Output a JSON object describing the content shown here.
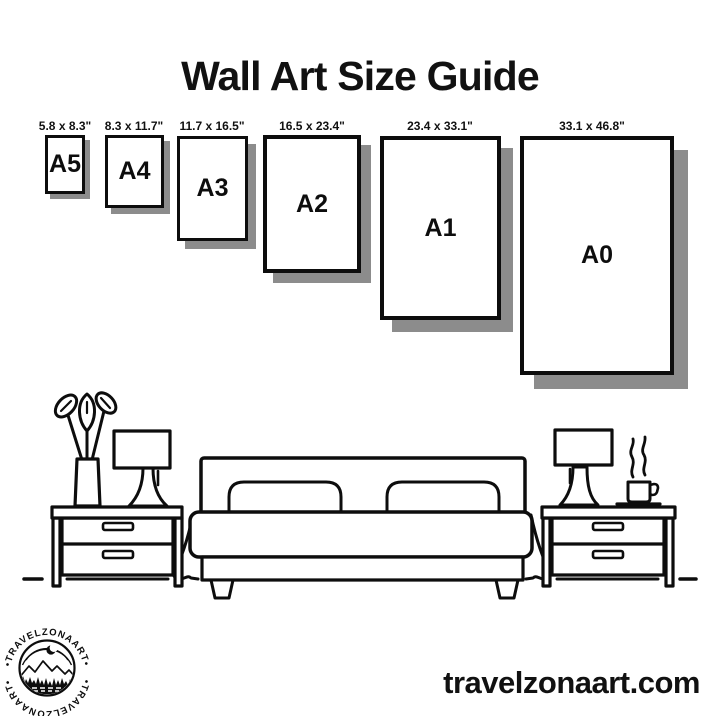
{
  "title": "Wall Art Size Guide",
  "frames": [
    {
      "name": "A5",
      "size": "5.8 x 8.3\""
    },
    {
      "name": "A4",
      "size": "8.3 x 11.7\""
    },
    {
      "name": "A3",
      "size": "11.7 x 16.5\""
    },
    {
      "name": "A2",
      "size": "16.5 x 23.4\""
    },
    {
      "name": "A1",
      "size": "23.4 x 33.1\""
    },
    {
      "name": "A0",
      "size": "33.1 x 46.8\""
    }
  ],
  "footer": {
    "website": "travelzonaart.com"
  },
  "logo": {
    "brand_top": "•TRAVELZONAART•",
    "brand_bottom": "•TRAVELZONAART•"
  },
  "illustration": {
    "items": [
      "flower-vase",
      "table-lamp",
      "nightstand",
      "double-bed",
      "nightstand",
      "table-lamp",
      "coffee-cup"
    ]
  },
  "colors": {
    "ink": "#0d0d0d",
    "shadow": "#8c8c8c",
    "background": "#ffffff"
  }
}
